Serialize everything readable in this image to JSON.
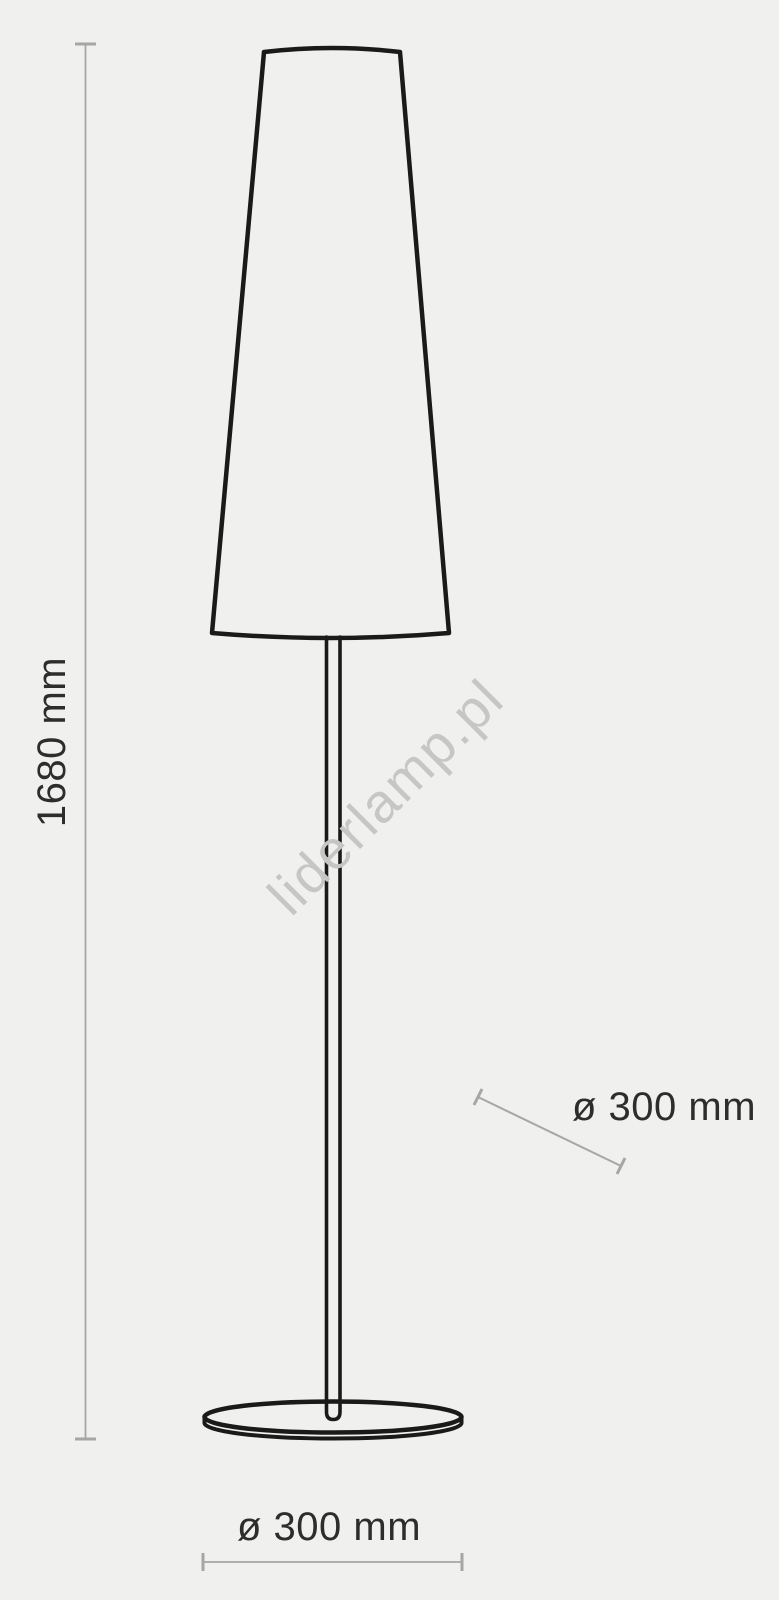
{
  "colors": {
    "background": "#f0f0ee",
    "drawing": "#1a1a1a",
    "dimension": "#a6a6a6",
    "text": "#2d2d2d",
    "watermark": "#c6c6c4"
  },
  "labels": {
    "height": "1680 mm",
    "shade_diameter": "ø 300 mm",
    "base_diameter": "ø 300 mm"
  },
  "watermark": {
    "text": "liderlamp.pl"
  }
}
